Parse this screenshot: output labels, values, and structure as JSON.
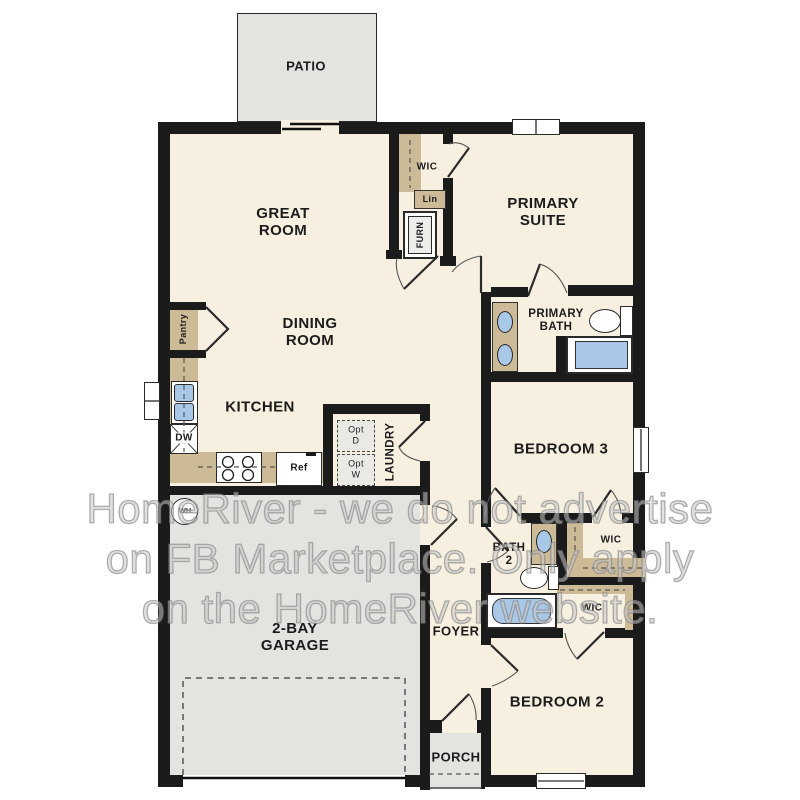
{
  "title": "single-story floor plan",
  "watermark": {
    "lines": [
      "HomeRiver - we do not advertise",
      "on FB Marketplace. Only apply",
      "on the HomeRiver website."
    ]
  },
  "labels": {
    "patio": "PATIO",
    "great_room": [
      "GREAT",
      "ROOM"
    ],
    "wic_primary": "WIC",
    "lin": "Lin",
    "furn": "FURN",
    "primary_suite": [
      "PRIMARY",
      "SUITE"
    ],
    "primary_bath": [
      "PRIMARY",
      "BATH"
    ],
    "dining_room": [
      "DINING",
      "ROOM"
    ],
    "kitchen": "KITCHEN",
    "pantry": "Pantry",
    "dw": "DW",
    "ref": "Ref",
    "opt_d": [
      "Opt",
      "D"
    ],
    "opt_w": [
      "Opt",
      "W"
    ],
    "laundry": "LAUNDRY",
    "bedroom3": "BEDROOM 3",
    "wic_bed3": "WIC",
    "bath2": [
      "BATH",
      "2"
    ],
    "wic_bed2": "WIC",
    "garage": [
      "2-BAY",
      "GARAGE"
    ],
    "foyer": "FOYER",
    "bedroom2": "BEDROOM 2",
    "porch": "PORCH",
    "wh": "WH"
  },
  "colors": {
    "wall": "#1b1b1b",
    "floor": "#f7efe0",
    "hard_surface": "#e3e3e0",
    "counter_tan": "#cdbb97",
    "fixture_blue": "#a9c8e8",
    "watermark_gray": "#9a9a9a"
  }
}
